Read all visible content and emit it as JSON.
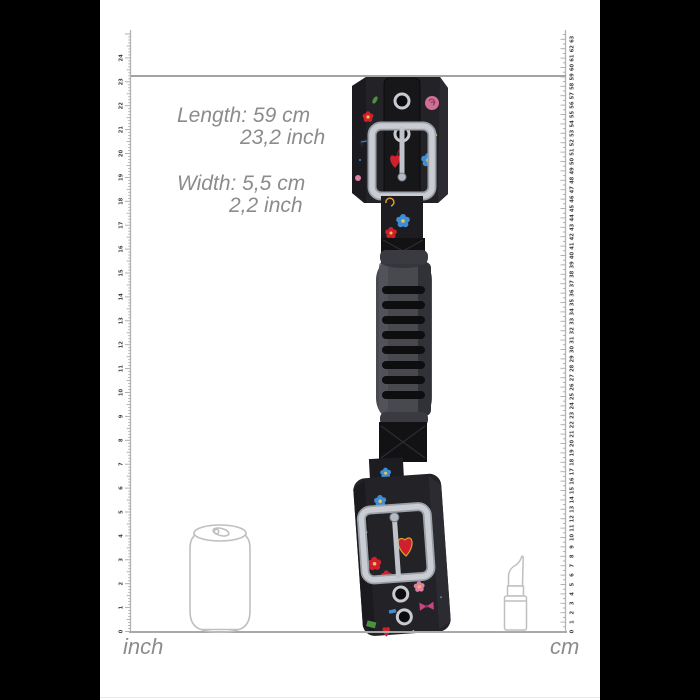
{
  "colors": {
    "side_panel": "#000000",
    "dimension_text_gray": "#8c8c8c",
    "guide_line_gray": "#a3a3a3",
    "ruler_gray": "#b4b4b4",
    "fabric_black": "#232327",
    "metal_silver": "#c9cdd3",
    "accent_red": "#cf2030",
    "accent_blue": "#3e8ed6",
    "accent_pink": "#df7fa4",
    "accent_yellow": "#e6c84b",
    "accent_green": "#4c9140"
  },
  "measurements": {
    "length_cm": "Length: 59 cm",
    "length_inch": "23,2 inch",
    "width_cm": "Width: 5,5 cm",
    "width_inch": "2,2 inch"
  },
  "rulers": {
    "left": {
      "unit_label": "inch",
      "min": 0,
      "max": 24
    },
    "right": {
      "unit_label": "cm",
      "min": 0,
      "max": 63
    }
  },
  "product": {
    "name": "floral-print-wrist-cuffs-with-grip-handle",
    "marked_length": {
      "cm": 59,
      "inch": 23.2
    },
    "marked_width": {
      "cm": 5.5,
      "inch": 2.2
    }
  },
  "reference_objects": [
    {
      "name": "soda-can"
    },
    {
      "name": "lipstick"
    }
  ]
}
